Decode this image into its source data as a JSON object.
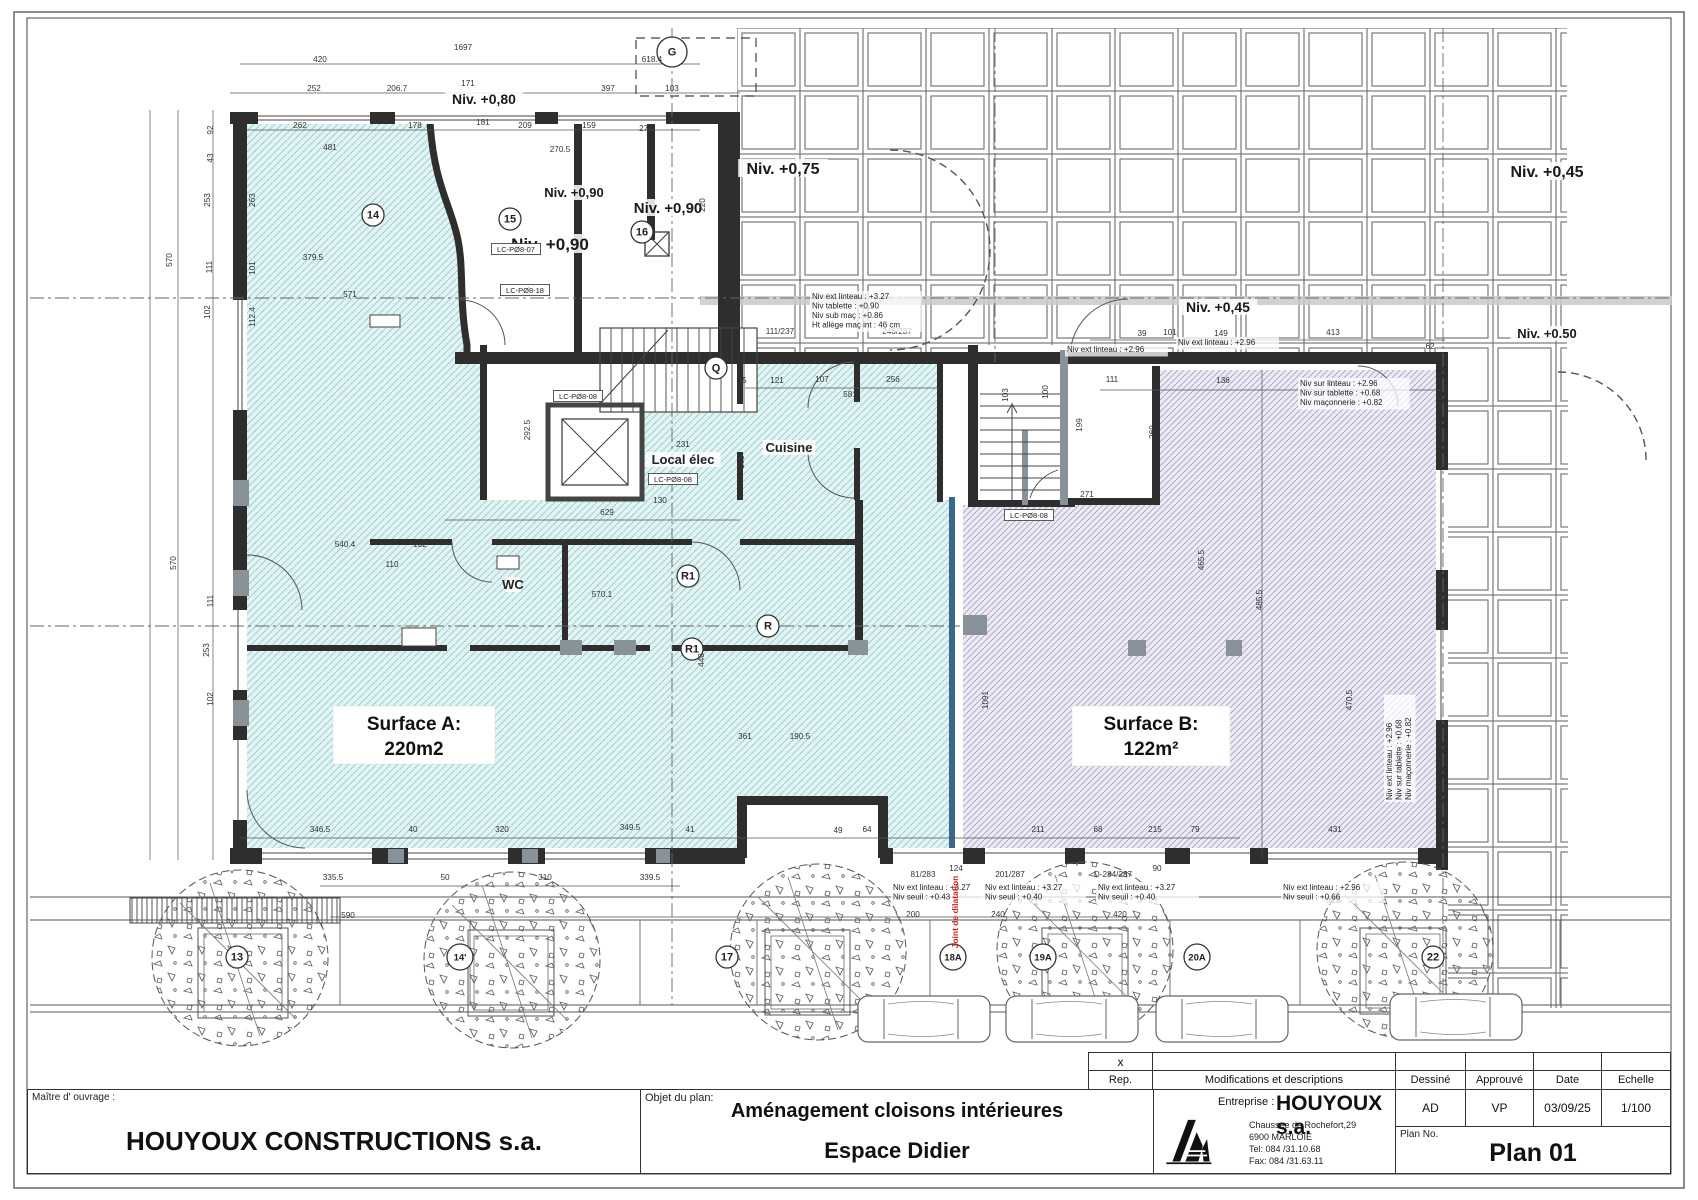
{
  "surfaces": {
    "a_label": "Surface A:",
    "a_area": "220m2",
    "b_label": "Surface B:",
    "b_area": "122m²"
  },
  "levels": [
    {
      "t": "Niv. +0,80",
      "x": 484,
      "y": 104,
      "s": 14
    },
    {
      "t": "Niv. +0,90",
      "x": 574,
      "y": 197,
      "s": 13
    },
    {
      "t": "Niv. +0,90",
      "x": 668,
      "y": 213,
      "s": 15
    },
    {
      "t": "Niv. +0,90",
      "x": 550,
      "y": 250,
      "s": 17
    },
    {
      "t": "Niv. +0,75",
      "x": 783,
      "y": 174,
      "s": 16
    },
    {
      "t": "Niv. +0,45",
      "x": 1547,
      "y": 177,
      "s": 16
    },
    {
      "t": "Niv. +0,45",
      "x": 1218,
      "y": 312,
      "s": 14
    },
    {
      "t": "Niv. +0.50",
      "x": 1547,
      "y": 338,
      "s": 13
    }
  ],
  "rooms": [
    {
      "t": "Cuisine",
      "x": 789,
      "y": 452
    },
    {
      "t": "Local élec",
      "x": 683,
      "y": 464
    },
    {
      "t": "WC",
      "x": 513,
      "y": 589
    }
  ],
  "markers": [
    {
      "t": "G",
      "x": 672,
      "y": 52
    },
    {
      "t": "14",
      "x": 373,
      "y": 215
    },
    {
      "t": "15",
      "x": 510,
      "y": 219
    },
    {
      "t": "16",
      "x": 642,
      "y": 232
    },
    {
      "t": "Q",
      "x": 716,
      "y": 368
    },
    {
      "t": "R1",
      "x": 688,
      "y": 576
    },
    {
      "t": "R1",
      "x": 692,
      "y": 649
    },
    {
      "t": "R",
      "x": 768,
      "y": 626
    },
    {
      "t": "13",
      "x": 237,
      "y": 957
    },
    {
      "t": "14'",
      "x": 460,
      "y": 957
    },
    {
      "t": "17",
      "x": 727,
      "y": 957
    },
    {
      "t": "18A",
      "x": 953,
      "y": 957
    },
    {
      "t": "19A",
      "x": 1043,
      "y": 957
    },
    {
      "t": "20A",
      "x": 1197,
      "y": 957
    },
    {
      "t": "22",
      "x": 1433,
      "y": 957
    }
  ],
  "annotations": [
    {
      "x": 812,
      "y": 299,
      "lines": [
        "Niv ext linteau :  +3.27",
        "Niv tablette :  +0.90",
        "Niv sub maç :  +0.86",
        "Ht allège maç int : 46 cm"
      ]
    },
    {
      "x": 1300,
      "y": 386,
      "lines": [
        "Niv sur linteau :  +2.96",
        "Niv sur tablette :  +0.68",
        "Niv maçonnerie :  +0.82"
      ]
    },
    {
      "x": 1067,
      "y": 352,
      "lines": [
        "Niv ext linteau : +2.96"
      ]
    },
    {
      "x": 1178,
      "y": 345,
      "lines": [
        "Niv ext linteau : +2.96"
      ]
    },
    {
      "x": 893,
      "y": 890,
      "lines": [
        "Niv ext linteau : +3.27",
        "Niv seuil : +0.43"
      ]
    },
    {
      "x": 985,
      "y": 890,
      "lines": [
        "Niv ext linteau : +3.27",
        "Niv seuil : +0.40"
      ]
    },
    {
      "x": 1098,
      "y": 890,
      "lines": [
        "Niv ext linteau : +3.27",
        "Niv seuil : +0.40"
      ]
    },
    {
      "x": 1283,
      "y": 890,
      "lines": [
        "Niv ext linteau : +2.96",
        "Niv seuil : +0.66"
      ]
    },
    {
      "x": 1392,
      "y": 800,
      "rot": 1,
      "lines": [
        "Niv ext linteau : +2.96",
        "Niv sur tablette : +0.68",
        "Niv maçonnerie : +0.82"
      ]
    }
  ],
  "joint_label": {
    "t": "Joint de dilatation",
    "x": 958,
    "y": 912,
    "color": "#cc2222"
  },
  "boxed_labels": [
    {
      "t": "LC-PØ8-07",
      "x": 516,
      "y": 252
    },
    {
      "t": "LC-PØ8-18",
      "x": 525,
      "y": 293
    },
    {
      "t": "LC-PØ8-08",
      "x": 578,
      "y": 399
    },
    {
      "t": "LC-PØ8-08",
      "x": 673,
      "y": 482
    },
    {
      "t": "LC-PØ8-08",
      "x": 1029,
      "y": 518
    }
  ],
  "dimensions": [
    {
      "t": "1697",
      "x": 463,
      "y": 50
    },
    {
      "t": "420",
      "x": 320,
      "y": 62
    },
    {
      "t": "618.4",
      "x": 652,
      "y": 62
    },
    {
      "t": "252",
      "x": 314,
      "y": 91
    },
    {
      "t": "206.7",
      "x": 397,
      "y": 91
    },
    {
      "t": "171",
      "x": 468,
      "y": 86
    },
    {
      "t": "397",
      "x": 608,
      "y": 91
    },
    {
      "t": "103",
      "x": 672,
      "y": 91
    },
    {
      "t": "262",
      "x": 300,
      "y": 128
    },
    {
      "t": "178",
      "x": 415,
      "y": 128
    },
    {
      "t": "181",
      "x": 483,
      "y": 125
    },
    {
      "t": "209",
      "x": 525,
      "y": 128
    },
    {
      "t": "159",
      "x": 589,
      "y": 128
    },
    {
      "t": "272",
      "x": 646,
      "y": 131
    },
    {
      "t": "270.5",
      "x": 560,
      "y": 152
    },
    {
      "t": "481",
      "x": 330,
      "y": 150
    },
    {
      "t": "220",
      "x": 705,
      "y": 205,
      "r": 1
    },
    {
      "t": "92",
      "x": 213,
      "y": 130,
      "r": 1
    },
    {
      "t": "43",
      "x": 213,
      "y": 158,
      "r": 1
    },
    {
      "t": "253",
      "x": 210,
      "y": 200,
      "r": 1
    },
    {
      "t": "263",
      "x": 255,
      "y": 200,
      "r": 1
    },
    {
      "t": "570",
      "x": 172,
      "y": 260,
      "r": 1
    },
    {
      "t": "111",
      "x": 212,
      "y": 267,
      "r": 1
    },
    {
      "t": "101",
      "x": 255,
      "y": 268,
      "r": 1
    },
    {
      "t": "102",
      "x": 210,
      "y": 312,
      "r": 1
    },
    {
      "t": "112.4",
      "x": 255,
      "y": 317,
      "r": 1
    },
    {
      "t": "570",
      "x": 176,
      "y": 563,
      "r": 1
    },
    {
      "t": "111",
      "x": 213,
      "y": 601,
      "r": 1
    },
    {
      "t": "253",
      "x": 209,
      "y": 650,
      "r": 1
    },
    {
      "t": "102",
      "x": 213,
      "y": 699,
      "r": 1
    },
    {
      "t": "379.5",
      "x": 313,
      "y": 260
    },
    {
      "t": "571",
      "x": 350,
      "y": 297
    },
    {
      "t": "540.4",
      "x": 345,
      "y": 547
    },
    {
      "t": "132",
      "x": 420,
      "y": 547
    },
    {
      "t": "110",
      "x": 392,
      "y": 567
    },
    {
      "t": "570.1",
      "x": 602,
      "y": 597
    },
    {
      "t": "629",
      "x": 607,
      "y": 515
    },
    {
      "t": "130",
      "x": 660,
      "y": 503
    },
    {
      "t": "231",
      "x": 683,
      "y": 447
    },
    {
      "t": "165",
      "x": 744,
      "y": 462,
      "r": 1
    },
    {
      "t": "292.5",
      "x": 530,
      "y": 430,
      "r": 1
    },
    {
      "t": "45",
      "x": 742,
      "y": 383
    },
    {
      "t": "121",
      "x": 777,
      "y": 383
    },
    {
      "t": "107",
      "x": 822,
      "y": 382
    },
    {
      "t": "256",
      "x": 893,
      "y": 382
    },
    {
      "t": "581",
      "x": 850,
      "y": 397
    },
    {
      "t": "111/237",
      "x": 780,
      "y": 334
    },
    {
      "t": "246/237",
      "x": 897,
      "y": 334
    },
    {
      "t": "103",
      "x": 1008,
      "y": 395,
      "r": 1
    },
    {
      "t": "100",
      "x": 1048,
      "y": 392,
      "r": 1
    },
    {
      "t": "199",
      "x": 1082,
      "y": 425,
      "r": 1
    },
    {
      "t": "271",
      "x": 1087,
      "y": 497
    },
    {
      "t": "39",
      "x": 1142,
      "y": 336
    },
    {
      "t": "101",
      "x": 1170,
      "y": 335
    },
    {
      "t": "149",
      "x": 1221,
      "y": 336
    },
    {
      "t": "413",
      "x": 1333,
      "y": 335
    },
    {
      "t": "62",
      "x": 1430,
      "y": 349
    },
    {
      "t": "111",
      "x": 1112,
      "y": 382
    },
    {
      "t": "136",
      "x": 1223,
      "y": 383
    },
    {
      "t": "422",
      "x": 1335,
      "y": 386
    },
    {
      "t": "269",
      "x": 1155,
      "y": 432,
      "r": 1
    },
    {
      "t": "485.5",
      "x": 1262,
      "y": 600,
      "r": 1
    },
    {
      "t": "465.5",
      "x": 1204,
      "y": 560,
      "r": 1
    },
    {
      "t": "470.5",
      "x": 1352,
      "y": 700,
      "r": 1
    },
    {
      "t": "448",
      "x": 704,
      "y": 660,
      "r": 1
    },
    {
      "t": "1091",
      "x": 988,
      "y": 700,
      "r": 1
    },
    {
      "t": "361",
      "x": 745,
      "y": 739
    },
    {
      "t": "190.5",
      "x": 800,
      "y": 739
    },
    {
      "t": "346.5",
      "x": 320,
      "y": 832
    },
    {
      "t": "40",
      "x": 413,
      "y": 832
    },
    {
      "t": "320",
      "x": 502,
      "y": 832
    },
    {
      "t": "349.5",
      "x": 630,
      "y": 830
    },
    {
      "t": "41",
      "x": 690,
      "y": 832
    },
    {
      "t": "49",
      "x": 838,
      "y": 833
    },
    {
      "t": "64",
      "x": 867,
      "y": 832
    },
    {
      "t": "211",
      "x": 1038,
      "y": 832
    },
    {
      "t": "68",
      "x": 1098,
      "y": 832
    },
    {
      "t": "215",
      "x": 1155,
      "y": 832
    },
    {
      "t": "79",
      "x": 1195,
      "y": 832
    },
    {
      "t": "431",
      "x": 1335,
      "y": 832
    },
    {
      "t": "335.5",
      "x": 333,
      "y": 880
    },
    {
      "t": "50",
      "x": 445,
      "y": 880
    },
    {
      "t": "310",
      "x": 545,
      "y": 880
    },
    {
      "t": "339.5",
      "x": 650,
      "y": 880
    },
    {
      "t": "590",
      "x": 348,
      "y": 918
    },
    {
      "t": "45.5",
      "x": 690,
      "y": 856
    },
    {
      "t": "42.5",
      "x": 712,
      "y": 856
    },
    {
      "t": "200",
      "x": 913,
      "y": 917
    },
    {
      "t": "240",
      "x": 998,
      "y": 917
    },
    {
      "t": "420",
      "x": 1120,
      "y": 917
    },
    {
      "t": "529",
      "x": 1333,
      "y": 903
    },
    {
      "t": "81/283",
      "x": 923,
      "y": 877
    },
    {
      "t": "124",
      "x": 956,
      "y": 871
    },
    {
      "t": "201/287",
      "x": 1010,
      "y": 877
    },
    {
      "t": "D-284/287",
      "x": 1113,
      "y": 877
    },
    {
      "t": "90",
      "x": 1157,
      "y": 871
    }
  ],
  "titleblock": {
    "maitre_label": "Maître d' ouvrage :",
    "maitre": "HOUYOUX CONSTRUCTIONS s.a.",
    "objet_label": "Objet du plan:",
    "objet_line1": "Aménagement cloisons intérieures",
    "objet_line2": "Espace Didier",
    "entreprise_label": "Entreprise :",
    "entreprise": "HOUYOUX s.a.",
    "address": [
      "Chaussee de Rochefort,29",
      "6900 MARLOIE",
      "Tel: 084 /31.10.68",
      "Fax: 084 /31.63.11"
    ],
    "x_mark": "x",
    "rep": "Rep.",
    "modifications": "Modifications et descriptions",
    "dessine_h": "Dessiné",
    "approuve_h": "Approuvé",
    "date_h": "Date",
    "echelle_h": "Echelle",
    "dessine": "AD",
    "approuve": "VP",
    "date": "03/09/25",
    "echelle": "1/100",
    "plan_no_label": "Plan No.",
    "plan_no": "Plan 01"
  },
  "colors": {
    "surface_a_fill": "#e2f3f3",
    "surface_a_hatch": "#96c9c9",
    "surface_b_fill": "#edeaf4",
    "surface_b_hatch": "#a99fc6",
    "wall": "#2e2e2e",
    "joint_wall": "#39678f",
    "joint_text": "#cc2222",
    "line": "#555555"
  }
}
